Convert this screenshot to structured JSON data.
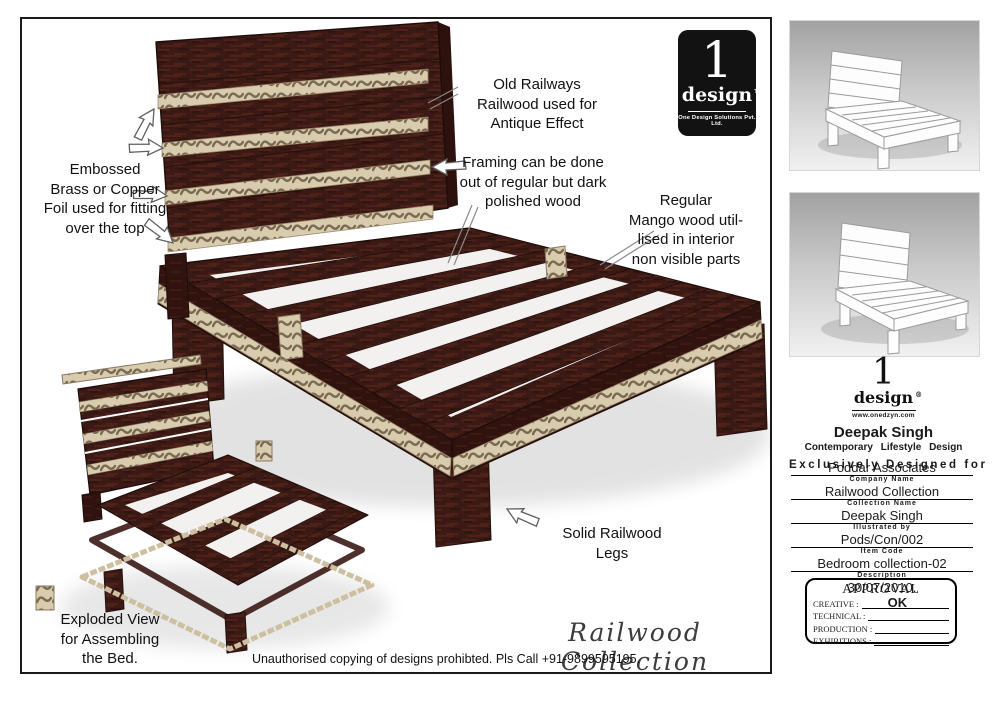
{
  "main": {
    "annotations": {
      "old_railways": "Old Railways\nRailwood used for\nAntique Effect",
      "embossed": "Embossed\nBrass or Copper\nFoil used for fitting\nover the top",
      "framing": "Framing can be done\nout of regular but dark\npolished wood",
      "mango": "Regular\nMango wood util-\nlised in interior\nnon visible parts",
      "legs": "Solid Railwood\nLegs",
      "exploded": "Exploded View\nfor Assembling\nthe Bed."
    },
    "collection_script": "Railwood Collection",
    "disclaimer": "Unauthorised copying of designs prohibted. Pls Call +91-9899595195.",
    "logo": {
      "numeral": "1",
      "name": "design",
      "tm": "TM",
      "company": "One Design Solutions Pvt. Ltd."
    }
  },
  "sidebar": {
    "logo": {
      "numeral": "1",
      "name": "design",
      "reg": "®",
      "website": "www.onedzyn.com"
    },
    "designer": "Deepak Singh",
    "tagline": "Contemporary Lifestyle Design",
    "exclusive": "Exclusively Designed for",
    "fields": [
      {
        "value": "Poddar Associates",
        "label": "Company Name"
      },
      {
        "value": "Railwood Collection",
        "label": "Collection Name"
      },
      {
        "value": "Deepak Singh",
        "label": "Illustrated by"
      },
      {
        "value": "Pods/Con/002",
        "label": "Item Code"
      },
      {
        "value": "Bedroom collection-02",
        "label": "Description"
      },
      {
        "value": "30/07/2010.",
        "label": ""
      }
    ],
    "approval": {
      "title": "APPROVAL",
      "rows": [
        {
          "label": "CREATIVE :",
          "value": "OK"
        },
        {
          "label": "TECHNICAL :",
          "value": ""
        },
        {
          "label": "PRODUCTION :",
          "value": ""
        },
        {
          "label": "EXHIBITIONS :",
          "value": ""
        }
      ]
    }
  },
  "colors": {
    "wood_dark": "#3b1a15",
    "wood_face": "#2f120e",
    "trim_beige": "#d8cbae",
    "trim_pattern": "#7b6a52",
    "logo_bg": "#121212",
    "thumb_bg_top": "#a2a2a2",
    "thumb_bg_bottom": "#f1f1f1"
  }
}
